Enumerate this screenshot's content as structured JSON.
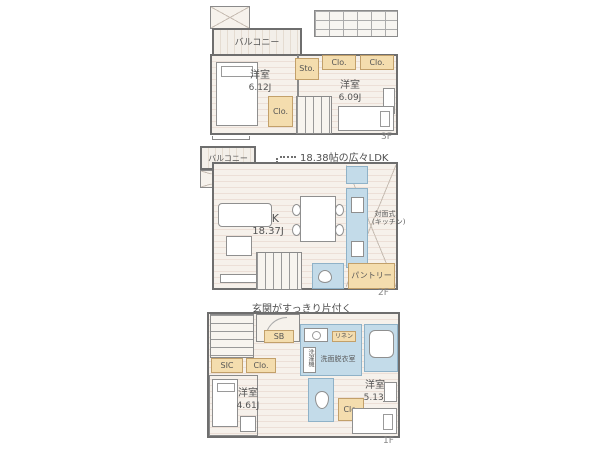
{
  "floor3": {
    "floor_label": "3F",
    "balcony": "バルコニー",
    "bedroom_left": "洋室",
    "bedroom_left_size": "6.12J",
    "storage": "Sto.",
    "closet_a": "Clo.",
    "closet_b": "Clo.",
    "closet_c": "Clo.",
    "bedroom_right": "洋室",
    "bedroom_right_size": "6.09J"
  },
  "floor2": {
    "floor_label": "2F",
    "annotation": "18.38帖の広々LDK",
    "balcony": "バルコニー",
    "void_label": "上部吹抜",
    "ldk": "LDK",
    "ldk_size": "18.37J",
    "kitchen_note_1": "対面式",
    "kitchen_note_2": "(キッチン)",
    "pantry": "パントリー"
  },
  "floor1": {
    "floor_label": "1F",
    "annotation_1": "玄関がすっきり片付く",
    "annotation_2": "シューズインクローゼット",
    "shoe_box": "SB",
    "sic": "SIC",
    "closet_hall": "Clo.",
    "washroom": "洗面脱衣室",
    "linen": "リネン",
    "laundry": "洗濯機",
    "bedroom_left": "洋室",
    "bedroom_left_size": "4.61J",
    "closet_right": "Clo.",
    "bedroom_right": "洋室",
    "bedroom_right_size": "5.13J"
  },
  "colors": {
    "closet_fill": "#f4ddae",
    "wet_area_fill": "#c3dbe9",
    "wall": "#6e6e6e",
    "floor_fill": "#f6f1eb"
  }
}
